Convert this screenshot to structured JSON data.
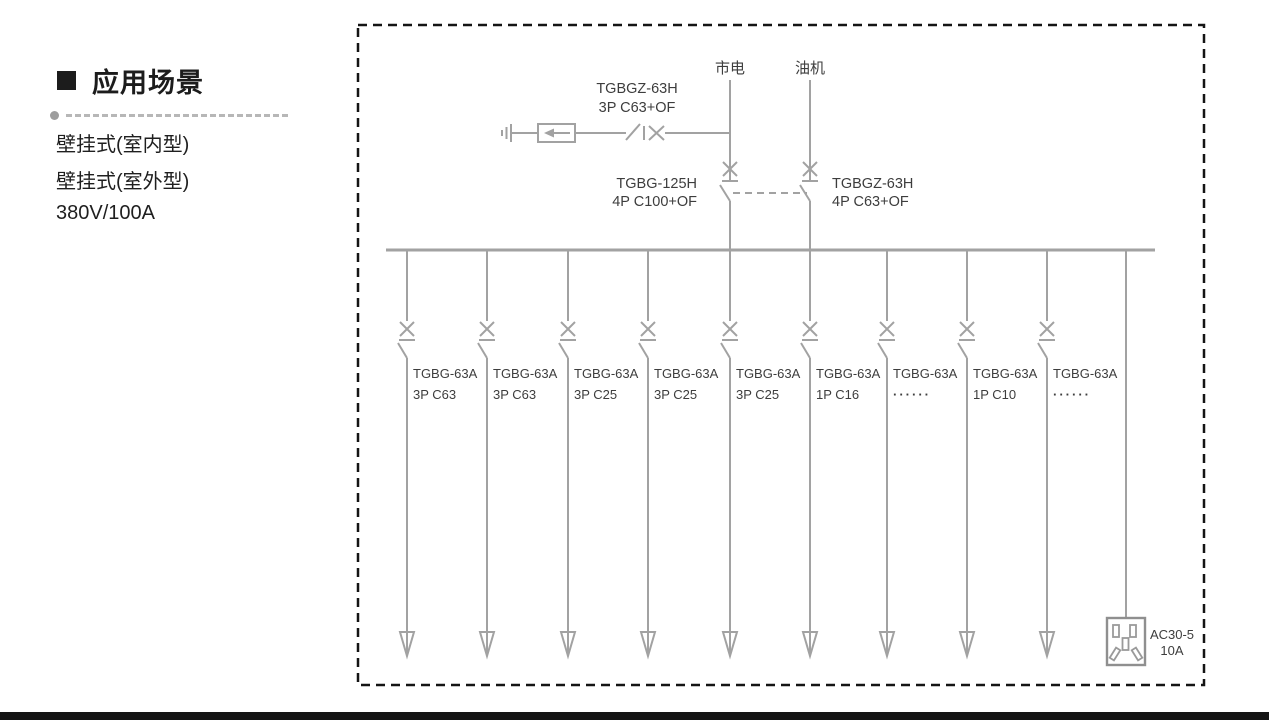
{
  "section": {
    "title": "应用场景",
    "features": [
      "壁挂式(室内型)",
      "壁挂式(室外型)",
      "380V/100A"
    ]
  },
  "diagram": {
    "sources": [
      {
        "label": "市电"
      },
      {
        "label": "油机"
      }
    ],
    "spd_branch_breaker": {
      "model": "TGBGZ-63H",
      "spec": "3P C63+OF"
    },
    "mains_breaker": {
      "model": "TGBG-125H",
      "spec": "4P C100+OF"
    },
    "generator_breaker": {
      "model": "TGBGZ-63H",
      "spec": "4P C63+OF"
    },
    "feeders": [
      {
        "model": "TGBG-63A",
        "spec": "3P C63"
      },
      {
        "model": "TGBG-63A",
        "spec": "3P C63"
      },
      {
        "model": "TGBG-63A",
        "spec": "3P C25"
      },
      {
        "model": "TGBG-63A",
        "spec": "3P C25"
      },
      {
        "model": "TGBG-63A",
        "spec": "3P C25"
      },
      {
        "model": "TGBG-63A",
        "spec": "1P C16"
      },
      {
        "model": "TGBG-63A",
        "spec": "······"
      },
      {
        "model": "TGBG-63A",
        "spec": "1P C10"
      },
      {
        "model": "TGBG-63A",
        "spec": "······"
      }
    ],
    "socket": {
      "model": "AC30-5",
      "rating": "10A"
    }
  },
  "colors": {
    "diagram_line": "#a2a2a2",
    "diagram_text": "#3d3d3d",
    "border": "#141414",
    "heading_text": "#1c1c1c"
  }
}
